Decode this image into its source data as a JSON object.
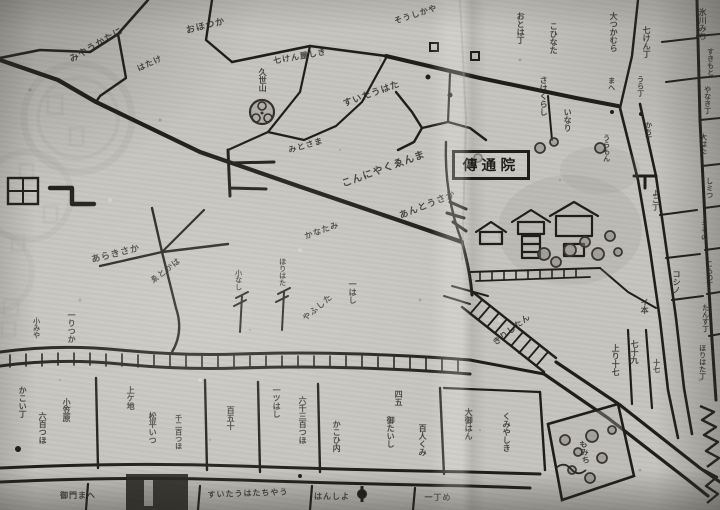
{
  "colors": {
    "paper": "#c6c5c0",
    "ink": "#201e19",
    "ink_soft": "#2b2a23",
    "stamp": "#b6b5b1"
  },
  "temple": {
    "label": "傳通院"
  },
  "symbols": {
    "rice_field_glyph": "田",
    "gate_marker_glyph": "口"
  },
  "labels": [
    {
      "t": "みやうかたに",
      "x": 97,
      "y": 46,
      "r": -30,
      "s": 9,
      "m": "h"
    },
    {
      "t": "おほつか",
      "x": 206,
      "y": 27,
      "r": -14,
      "s": 9,
      "m": "h"
    },
    {
      "t": "はたけ",
      "x": 150,
      "y": 64,
      "r": -25,
      "s": 8,
      "m": "h"
    },
    {
      "t": "七けん屋しき",
      "x": 300,
      "y": 57,
      "r": -10,
      "s": 8,
      "m": "h"
    },
    {
      "t": "久世山",
      "x": 262,
      "y": 80,
      "r": 0,
      "s": 8,
      "m": "v"
    },
    {
      "t": "そうしかや",
      "x": 416,
      "y": 15,
      "r": -18,
      "s": 8,
      "m": "h"
    },
    {
      "t": "おとは丁",
      "x": 520,
      "y": 28,
      "r": 0,
      "s": 8,
      "m": "v"
    },
    {
      "t": "こひなた",
      "x": 553,
      "y": 38,
      "r": 0,
      "s": 8,
      "m": "v"
    },
    {
      "t": "すいたうはた",
      "x": 372,
      "y": 95,
      "r": -20,
      "s": 9,
      "m": "h"
    },
    {
      "t": "こんにやくゑんま",
      "x": 384,
      "y": 170,
      "r": -20,
      "s": 10,
      "m": "h"
    },
    {
      "t": "あんとうさか",
      "x": 428,
      "y": 206,
      "r": -22,
      "s": 9,
      "m": "h"
    },
    {
      "t": "みとさま",
      "x": 306,
      "y": 146,
      "r": -16,
      "s": 8,
      "m": "h"
    },
    {
      "t": "さはくらし",
      "x": 543,
      "y": 96,
      "r": 0,
      "s": 8,
      "m": "v"
    },
    {
      "t": "いなり",
      "x": 567,
      "y": 120,
      "r": 0,
      "s": 8,
      "m": "v"
    },
    {
      "t": "うらもん",
      "x": 606,
      "y": 148,
      "r": 0,
      "s": 7,
      "m": "v"
    },
    {
      "t": "大つかむら",
      "x": 613,
      "y": 32,
      "r": 0,
      "s": 8,
      "m": "v"
    },
    {
      "t": "七けん丁",
      "x": 646,
      "y": 42,
      "r": 0,
      "s": 8,
      "m": "v"
    },
    {
      "t": "氷川みち",
      "x": 702,
      "y": 24,
      "r": 0,
      "s": 8,
      "m": "v"
    },
    {
      "t": "すきもと",
      "x": 710,
      "y": 62,
      "r": 0,
      "s": 7,
      "m": "v"
    },
    {
      "t": "やなき丁",
      "x": 707,
      "y": 100,
      "r": 0,
      "s": 7,
      "m": "v"
    },
    {
      "t": "大はた",
      "x": 703,
      "y": 144,
      "r": 0,
      "s": 7,
      "m": "v"
    },
    {
      "t": "しミつ",
      "x": 709,
      "y": 188,
      "r": 0,
      "s": 7,
      "m": "v"
    },
    {
      "t": "ミその",
      "x": 704,
      "y": 230,
      "r": 0,
      "s": 7,
      "m": "v"
    },
    {
      "t": "こもの丁",
      "x": 709,
      "y": 274,
      "r": 0,
      "s": 7,
      "m": "v"
    },
    {
      "t": "たんす丁",
      "x": 705,
      "y": 318,
      "r": 0,
      "s": 7,
      "m": "v"
    },
    {
      "t": "かち丁",
      "x": 648,
      "y": 132,
      "r": 0,
      "s": 7,
      "m": "v"
    },
    {
      "t": "よこ丁",
      "x": 655,
      "y": 200,
      "r": 0,
      "s": 7,
      "m": "v"
    },
    {
      "t": "コシノ",
      "x": 676,
      "y": 282,
      "r": 0,
      "s": 8,
      "m": "v"
    },
    {
      "t": "イ本",
      "x": 644,
      "y": 306,
      "r": 0,
      "s": 8,
      "m": "v"
    },
    {
      "t": "まへ",
      "x": 611,
      "y": 84,
      "r": 0,
      "s": 7,
      "m": "v"
    },
    {
      "t": "うら丁",
      "x": 640,
      "y": 86,
      "r": 0,
      "s": 7,
      "m": "v"
    },
    {
      "t": "あらきさか",
      "x": 116,
      "y": 255,
      "r": -14,
      "s": 9,
      "m": "h"
    },
    {
      "t": "かなたみ",
      "x": 322,
      "y": 231,
      "r": -20,
      "s": 8,
      "m": "h"
    },
    {
      "t": "ゑとかは",
      "x": 166,
      "y": 271,
      "r": -38,
      "s": 8,
      "m": "h"
    },
    {
      "t": "一はし",
      "x": 352,
      "y": 292,
      "r": 0,
      "s": 8,
      "m": "v"
    },
    {
      "t": "やふした",
      "x": 318,
      "y": 308,
      "r": -40,
      "s": 8,
      "m": "h"
    },
    {
      "t": "小なし",
      "x": 238,
      "y": 280,
      "r": 0,
      "s": 7,
      "m": "v"
    },
    {
      "t": "ほりはた",
      "x": 282,
      "y": 272,
      "r": 0,
      "s": 7,
      "m": "v"
    },
    {
      "t": "きりしたん",
      "x": 512,
      "y": 330,
      "r": -38,
      "s": 8,
      "m": "h"
    },
    {
      "t": "かこい丁",
      "x": 22,
      "y": 402,
      "r": 0,
      "s": 8,
      "m": "v"
    },
    {
      "t": "六百つほ",
      "x": 42,
      "y": 428,
      "r": 0,
      "s": 8,
      "m": "v"
    },
    {
      "t": "小笠原",
      "x": 66,
      "y": 410,
      "r": 0,
      "s": 8,
      "m": "v"
    },
    {
      "t": "上ケ地",
      "x": 130,
      "y": 398,
      "r": 0,
      "s": 8,
      "m": "v"
    },
    {
      "t": "松平いつ",
      "x": 152,
      "y": 428,
      "r": 0,
      "s": 8,
      "m": "v"
    },
    {
      "t": "千二百つほ",
      "x": 178,
      "y": 432,
      "r": 0,
      "s": 7,
      "m": "v"
    },
    {
      "t": "百五十",
      "x": 230,
      "y": 418,
      "r": 0,
      "s": 8,
      "m": "v"
    },
    {
      "t": "一ツはし",
      "x": 276,
      "y": 402,
      "r": 0,
      "s": 8,
      "m": "v"
    },
    {
      "t": "六千三百つほ",
      "x": 302,
      "y": 420,
      "r": 0,
      "s": 8,
      "m": "v"
    },
    {
      "t": "かこひ内",
      "x": 336,
      "y": 436,
      "r": 0,
      "s": 8,
      "m": "v"
    },
    {
      "t": "四五",
      "x": 398,
      "y": 398,
      "r": 0,
      "s": 8,
      "m": "v"
    },
    {
      "t": "御たいし",
      "x": 390,
      "y": 432,
      "r": 0,
      "s": 8,
      "m": "v"
    },
    {
      "t": "百人くみ",
      "x": 422,
      "y": 440,
      "r": 0,
      "s": 8,
      "m": "v"
    },
    {
      "t": "大御はん",
      "x": 468,
      "y": 424,
      "r": 0,
      "s": 8,
      "m": "v"
    },
    {
      "t": "くみやしき",
      "x": 506,
      "y": 432,
      "r": 0,
      "s": 8,
      "m": "v"
    },
    {
      "t": "上り十七",
      "x": 615,
      "y": 360,
      "r": 0,
      "s": 8,
      "m": "v"
    },
    {
      "t": "七十九",
      "x": 634,
      "y": 352,
      "r": 0,
      "s": 8,
      "m": "v"
    },
    {
      "t": "十七",
      "x": 656,
      "y": 366,
      "r": 0,
      "s": 7,
      "m": "v"
    },
    {
      "t": "ほりはた丁",
      "x": 702,
      "y": 362,
      "r": 0,
      "s": 7,
      "m": "v"
    },
    {
      "t": "もみち",
      "x": 584,
      "y": 452,
      "r": -8,
      "s": 8,
      "m": "v"
    },
    {
      "t": "すいたうはたちやう",
      "x": 248,
      "y": 494,
      "r": -2,
      "s": 8,
      "m": "h"
    },
    {
      "t": "御門まへ",
      "x": 78,
      "y": 496,
      "r": 0,
      "s": 8,
      "m": "h"
    },
    {
      "t": "はんしよ",
      "x": 332,
      "y": 497,
      "r": 0,
      "s": 8,
      "m": "h"
    },
    {
      "t": "一丁め",
      "x": 438,
      "y": 498,
      "r": 0,
      "s": 8,
      "m": "h"
    },
    {
      "t": "小みや",
      "x": 36,
      "y": 328,
      "r": 0,
      "s": 7,
      "m": "v"
    },
    {
      "t": "一りつか",
      "x": 71,
      "y": 327,
      "r": 0,
      "s": 8,
      "m": "v"
    }
  ]
}
